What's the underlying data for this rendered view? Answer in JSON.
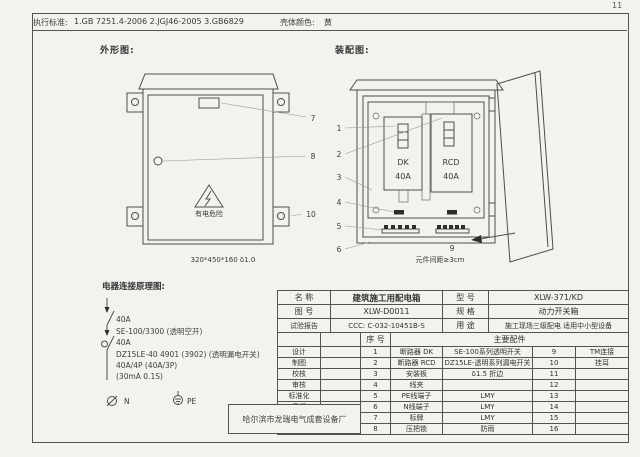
{
  "page": {
    "number": "11",
    "standards_label": "执行标准:",
    "standards": "1.GB 7251.4-2006    2.JGJ46-2005    3.GB6829",
    "shell_color_label": "壳体颜色:",
    "shell_color": "黄"
  },
  "outline": {
    "title": "外形图:",
    "warning": "有电危险",
    "dimension": "320*450*160  δ1.0",
    "callout_plate": "7",
    "callout_lock": "8",
    "callout_ear": "10"
  },
  "assembly": {
    "title": "装配图:",
    "dk_name": "DK",
    "dk_rating": "40A",
    "rcd_name": "RCD",
    "rcd_rating": "40A",
    "callouts": [
      "1",
      "2",
      "3",
      "4",
      "5",
      "6"
    ],
    "callout_terminal": "9",
    "note": "元件间距≥3cm"
  },
  "schematic": {
    "title": "电器连接原理图:",
    "lines": [
      "40A",
      "SE-100/3300 (透明空开)",
      "40A",
      "DZ15LE-40 4901 (3902) (透明漏电开关)",
      "40A/4P (40A/3P)",
      "(30mA 0.1S)"
    ],
    "n_label": "N",
    "pe_label": "PE"
  },
  "spec_table": {
    "rows_top": [
      {
        "k": "名  称",
        "v": "建筑施工用配电箱",
        "k2": "型  号",
        "v2": "XLW-371/KD"
      },
      {
        "k": "图  号",
        "v": "XLW-D0011",
        "k2": "规  格",
        "v2": "动力开关箱"
      },
      {
        "k": "试验报告",
        "v": "CCC: C-032-10451B-S",
        "k2": "用  途",
        "v2": "施工现场三级配电 适用中小型设备"
      }
    ],
    "seq_header": "序  号",
    "parts_header": "主要配件",
    "sign_labels": [
      "设计",
      "制图",
      "校核",
      "审核",
      "标准化",
      "日期"
    ],
    "parts": [
      {
        "no": "1",
        "name": "断路器 DK",
        "spec": "SE-100系列透明开关",
        "no2": "9",
        "name2": "TM连接"
      },
      {
        "no": "2",
        "name": "断路器 RCD",
        "spec": "DZ15LE-透明系列漏电开关",
        "no2": "10",
        "name2": "挂耳"
      },
      {
        "no": "3",
        "name": "安装板",
        "spec": "δ1.5 折边",
        "no2": "11",
        "name2": ""
      },
      {
        "no": "4",
        "name": "线夹",
        "spec": "",
        "no2": "12",
        "name2": ""
      },
      {
        "no": "5",
        "name": "PE线端子",
        "spec": "LMY",
        "no2": "13",
        "name2": ""
      },
      {
        "no": "6",
        "name": "N线端子",
        "spec": "LMY",
        "no2": "14",
        "name2": ""
      },
      {
        "no": "7",
        "name": "标牌",
        "spec": "LMY",
        "no2": "15",
        "name2": ""
      },
      {
        "no": "8",
        "name": "压把锁",
        "spec": "防雨",
        "no2": "16",
        "name2": ""
      }
    ],
    "company": "哈尔滨市龙瑞电气成套设备厂"
  }
}
